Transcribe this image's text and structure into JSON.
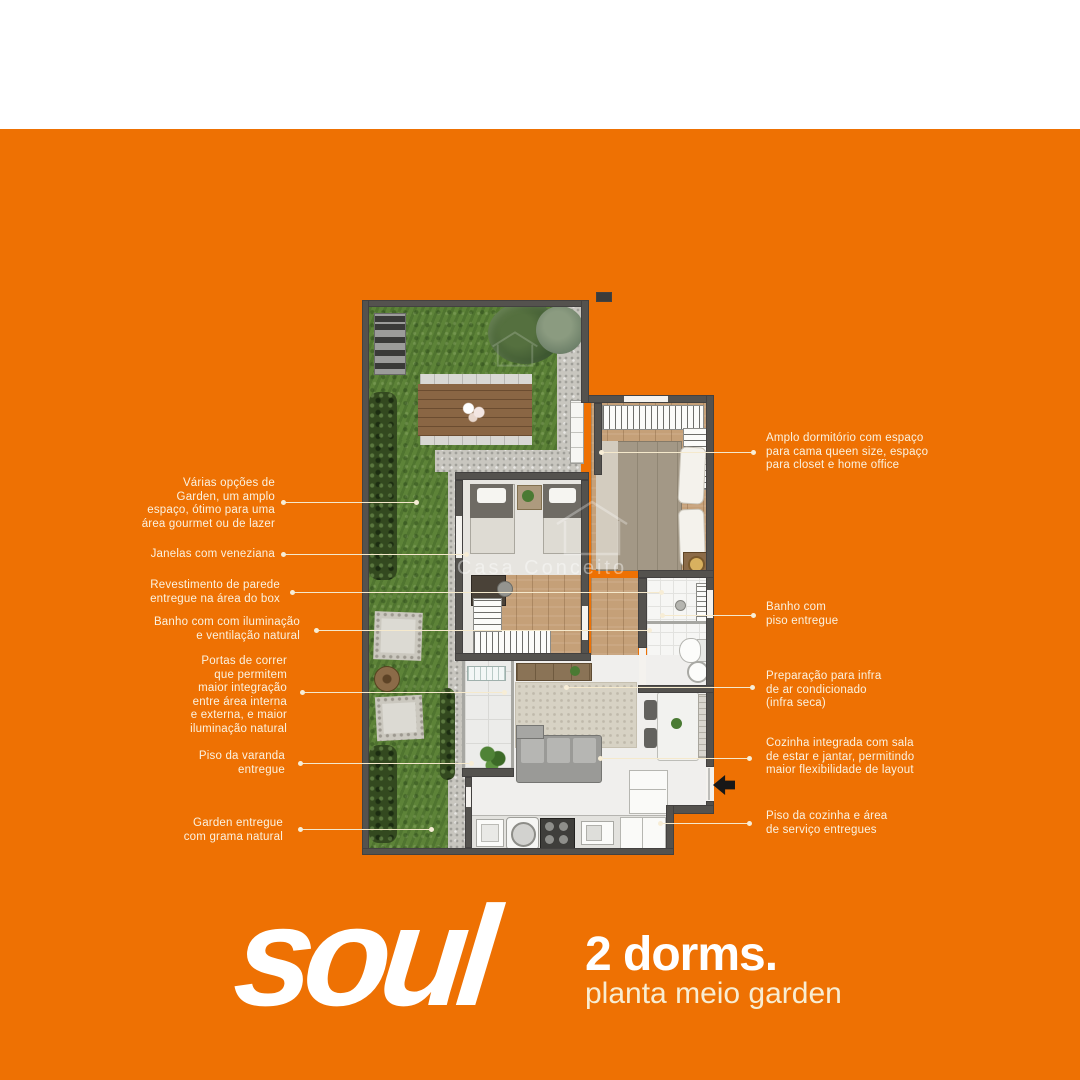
{
  "colors": {
    "background_orange": "#EE7103",
    "top_band_white": "#FFFFFF",
    "label_cream": "#FBF2E0",
    "leader_line_cream": "#F5E9CC",
    "logo_white": "#FFFFFF",
    "logo_subline_cream": "#F8EDD2"
  },
  "watermark": {
    "text": "Casa Conceito"
  },
  "annotations": {
    "left": [
      {
        "text": "Várias opções de\nGarden, um amplo\nespaço, ótimo para uma\nárea gourmet ou de lazer"
      },
      {
        "text": "Janelas com veneziana"
      },
      {
        "text": "Revestimento de parede\nentregue na área do box"
      },
      {
        "text": "Banho com com iluminação\ne ventilação natural"
      },
      {
        "text": "Portas de correr\nque permitem\nmaior integração\nentre área interna\ne externa, e maior\niluminação natural"
      },
      {
        "text": "Piso da varanda\nentregue"
      },
      {
        "text": "Garden entregue\ncom grama natural"
      }
    ],
    "right": [
      {
        "text": "Amplo dormitório com espaço\npara cama queen size, espaço\npara closet e home office"
      },
      {
        "text": "Banho com\npiso entregue"
      },
      {
        "text": "Preparação para infra\nde ar condicionado\n(infra seca)"
      },
      {
        "text": "Cozinha integrada com sala\nde estar e jantar, permitindo\nmaior flexibilidade de layout"
      },
      {
        "text": "Piso da cozinha e área\nde serviço entregues"
      }
    ]
  },
  "logo": {
    "brand": "soul",
    "headline": "2 dorms.",
    "subline": "planta meio garden"
  }
}
